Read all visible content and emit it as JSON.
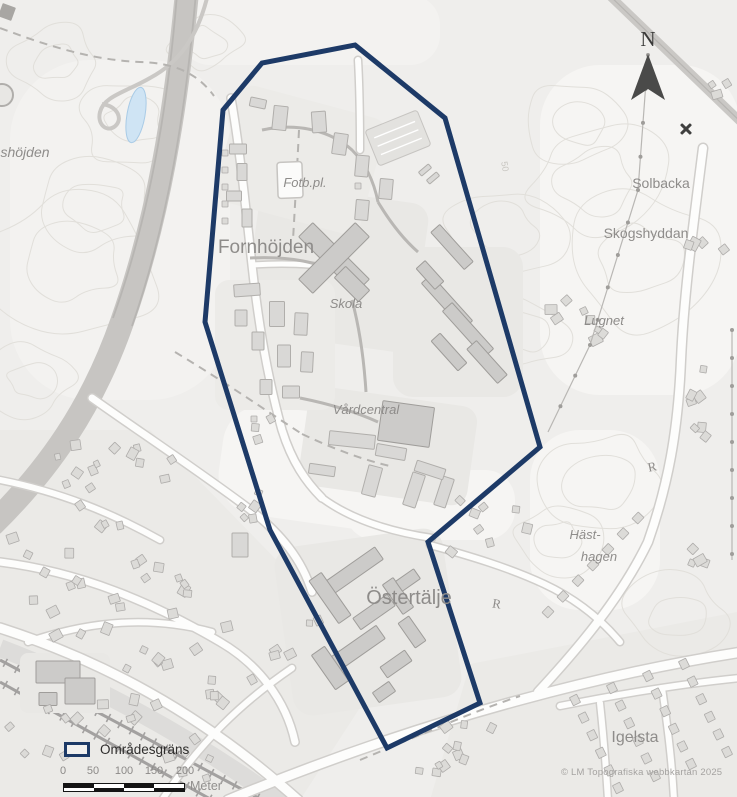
{
  "map": {
    "width": 737,
    "height": 797,
    "colors": {
      "bg": "#efeeec",
      "patch": "#f6f5f3",
      "patch2": "#f3f2f0",
      "urban": "#ebeae7",
      "contour": "#e1dfda",
      "platform": "#e9e8e5",
      "platform2": "#ecebe8",
      "road_fill": "#fdfdfc",
      "road_casing": "#d0cecb",
      "path_gray": "#b9b7b4",
      "dashed": "#b5b3b0",
      "railway": "#a3a1a0",
      "railband": "#dddcda",
      "highway": "#c7c5c2",
      "highway_lane": "#b7b5b2",
      "grayroad": "#cac8c5",
      "building_fill": "#d9d8d6",
      "building_stroke": "#b0aeab",
      "building_dark_fill": "#cccbc9",
      "building_dark_stroke": "#9f9d9a",
      "house_fill": "#dcdbd8",
      "house_stroke": "#aeacaa",
      "water": "#cfe4f4",
      "water_stroke": "#a9cbe6",
      "boundary": "#1d3a67",
      "label": "#8e8c8a",
      "label_faint": "#c8c6c1",
      "symbol_dark": "#3f3f3e",
      "field_fill": "#fbfbfa",
      "field_stroke": "#c6c4c1",
      "parking": "#e3e2df"
    },
    "boundary": {
      "points": [
        [
          355,
          45
        ],
        [
          445,
          118
        ],
        [
          540,
          447
        ],
        [
          428,
          542
        ],
        [
          480,
          703
        ],
        [
          387,
          748
        ],
        [
          270,
          530
        ],
        [
          205,
          322
        ],
        [
          223,
          110
        ],
        [
          262,
          63
        ]
      ],
      "stroke_width": 5
    },
    "labels": [
      {
        "text": "shöjden",
        "x": 25,
        "y": 157,
        "size": 14,
        "italic": true
      },
      {
        "text": "Fornhöjden",
        "x": 266,
        "y": 253,
        "size": 19
      },
      {
        "text": "Fotb.pl.",
        "x": 305,
        "y": 187,
        "size": 13,
        "italic": true
      },
      {
        "text": "Skola",
        "x": 346,
        "y": 308,
        "size": 13,
        "italic": true
      },
      {
        "text": "Vårdcentral",
        "x": 366,
        "y": 414,
        "size": 13,
        "italic": true
      },
      {
        "text": "Östertälje",
        "x": 409,
        "y": 604,
        "size": 20
      },
      {
        "text": "Solbacka",
        "x": 661,
        "y": 188,
        "size": 14
      },
      {
        "text": "Skogshyddan",
        "x": 646,
        "y": 238,
        "size": 14
      },
      {
        "text": "Lugnet",
        "x": 604,
        "y": 325,
        "size": 13,
        "italic": true
      },
      {
        "text": "Häst-",
        "x": 585,
        "y": 539,
        "size": 13,
        "italic": true
      },
      {
        "text": "hagen",
        "x": 599,
        "y": 561,
        "size": 13,
        "italic": true
      },
      {
        "text": "Igelsta",
        "x": 635,
        "y": 742,
        "size": 16
      },
      {
        "text": "R",
        "x": 653,
        "y": 471,
        "size": 13,
        "serif": true,
        "rotate": -12
      },
      {
        "text": "R",
        "x": 496,
        "y": 608,
        "size": 13,
        "serif": true,
        "rotate": 10
      },
      {
        "text": "50",
        "x": 502,
        "y": 167,
        "size": 9,
        "rotate": 80,
        "faint": true
      }
    ],
    "legend": {
      "label": "Områdesgräns"
    },
    "scalebar": {
      "ticks": [
        "0",
        "50",
        "100",
        "150",
        "200"
      ],
      "tick_x": [
        63,
        93,
        124,
        154,
        185
      ],
      "unit": "Meter"
    },
    "north": {
      "label": "N"
    },
    "copyright": "© LM Topografiska webbkartan 2025",
    "patches": [
      [
        640,
        230,
        200,
        330,
        60,
        0,
        "patch"
      ],
      [
        595,
        520,
        130,
        180,
        50,
        0,
        "patch"
      ],
      [
        120,
        230,
        220,
        340,
        80,
        0,
        "patch2"
      ],
      [
        310,
        30,
        260,
        70,
        30,
        0,
        "patch2"
      ],
      [
        330,
        470,
        220,
        110,
        40,
        8,
        "patch"
      ],
      [
        430,
        505,
        170,
        70,
        30,
        0,
        "patch"
      ]
    ],
    "urban": [
      {
        "points": "0,430 150,430 330,615 365,700 300,800 0,800"
      },
      {
        "points": "430,800 470,664 737,612 737,800"
      }
    ],
    "contours": [
      [
        95,
        205,
        62,
        3
      ],
      [
        72,
        262,
        95,
        7
      ],
      [
        132,
        122,
        55,
        13
      ],
      [
        58,
        62,
        46,
        19
      ],
      [
        598,
        182,
        75,
        23
      ],
      [
        642,
        262,
        85,
        29
      ],
      [
        578,
        122,
        55,
        31
      ],
      [
        600,
        482,
        66,
        37
      ],
      [
        558,
        540,
        46,
        41
      ],
      [
        676,
        618,
        55,
        43
      ],
      [
        505,
        232,
        64,
        47
      ],
      [
        522,
        332,
        48,
        53
      ],
      [
        30,
        380,
        46,
        59
      ],
      [
        205,
        42,
        38,
        61
      ]
    ],
    "railway": {
      "band": "M0,648 C90,682 190,736 285,805",
      "tracks": [
        [
          0,
          660,
          262,
          800
        ],
        [
          0,
          682,
          212,
          800
        ]
      ]
    },
    "highway": {
      "band": "M187,-8 C176,110 158,220 122,322 C92,408 48,470 -8,525",
      "lanes": [
        "M196,-8 C186,110 168,222 132,326",
        "M177,-6 C168,108 149,218 113,318"
      ]
    },
    "loop_road": "M208,-6 C198,36 180,62 150,78 C126,92 104,96 100,112 C97,124 106,132 114,127 C124,120 118,106 102,104",
    "topright_road": "M608,-6 L745,126",
    "platforms": [
      [
        336,
        268,
        170,
        150,
        18,
        8,
        "platform"
      ],
      [
        458,
        322,
        130,
        150,
        20,
        0,
        "platform"
      ],
      [
        388,
        446,
        170,
        100,
        16,
        8,
        "platform"
      ],
      [
        368,
        622,
        170,
        170,
        20,
        -8,
        "platform"
      ],
      [
        300,
        160,
        150,
        120,
        14,
        15,
        "platform2"
      ],
      [
        275,
        345,
        120,
        130,
        14,
        0,
        "platform2"
      ],
      [
        65,
        683,
        90,
        60,
        8,
        0,
        "platform"
      ]
    ],
    "roads": [
      [
        "M228,800 C320,762 420,727 520,700 C612,675 690,660 742,652",
        9
      ],
      [
        "M703,148 C692,235 684,295 681,360 C678,432 668,485 648,542 C620,600 575,652 538,692",
        8
      ],
      [
        "M600,703 C604,740 606,768 608,800",
        6
      ],
      [
        "M662,688 C668,730 672,762 674,800",
        6
      ],
      [
        "M92,398 C140,432 200,472 248,508 C282,534 302,560 312,592",
        7
      ],
      [
        "M0,562 C80,572 152,602 220,642 C258,664 286,700 295,742",
        7
      ],
      [
        "M162,800 C200,742 242,702 292,668",
        6
      ],
      [
        "M28,642 C92,620 152,616 212,632",
        6
      ],
      [
        "M0,480 C60,492 110,512 160,540",
        6
      ],
      [
        "M231,98 C240,150 246,210 252,265 C258,320 268,380 282,430 C292,462 306,482 322,498",
        7
      ],
      [
        "M358,60 C360,95 360,122 360,150",
        6
      ],
      [
        "M322,498 C352,520 392,532 432,538",
        6
      ],
      [
        "M430,545 C470,556 510,568 544,584 C574,598 600,618 620,642",
        6
      ],
      [
        "M0,628 C100,660 200,712 298,800",
        9
      ],
      [
        "M252,265 C298,262 328,266 352,272",
        5
      ],
      [
        "M560,706 C620,694 680,684 740,678",
        6
      ]
    ],
    "gray_paths": [
      "M262,130 C300,122 332,132 352,150 C366,164 374,182 378,202",
      "M378,202 C390,222 402,238 418,252",
      "M250,258 C290,256 320,262 344,276",
      "M300,398 C330,404 356,412 378,422",
      "M352,300 C360,330 364,360 366,392"
    ],
    "dashed_paths": [
      "M0,28 C48,46 92,60 140,62 C176,63 198,74 214,96",
      "M299,130 C297,170 295,205 293,240",
      "M175,352 C225,382 268,412 302,434",
      "M302,434 C336,450 364,460 390,466",
      "M360,760 C420,735 472,712 520,696"
    ],
    "buildings": [
      [
        280,
        118,
        14,
        24,
        6
      ],
      [
        319,
        122,
        14,
        21,
        -4
      ],
      [
        340,
        144,
        14,
        21,
        8
      ],
      [
        362,
        166,
        13,
        21,
        5
      ],
      [
        386,
        189,
        13,
        20,
        5
      ],
      [
        362,
        210,
        13,
        20,
        5
      ],
      [
        238,
        149,
        17,
        10,
        0
      ],
      [
        242,
        172,
        10,
        17,
        0
      ],
      [
        234,
        196,
        15,
        10,
        0
      ],
      [
        247,
        218,
        10,
        18,
        0
      ],
      [
        258,
        103,
        16,
        9,
        12
      ],
      [
        247,
        290,
        26,
        12,
        -4
      ],
      [
        277,
        314,
        15,
        25,
        0
      ],
      [
        301,
        324,
        13,
        22,
        3
      ],
      [
        284,
        356,
        13,
        22,
        0
      ],
      [
        307,
        362,
        12,
        20,
        3
      ],
      [
        258,
        341,
        12,
        18,
        0
      ],
      [
        241,
        318,
        12,
        16,
        0
      ],
      [
        291,
        392,
        17,
        12,
        0
      ],
      [
        266,
        387,
        12,
        15,
        0
      ],
      [
        425,
        170,
        13,
        5,
        -40
      ],
      [
        433,
        178,
        13,
        5,
        -40
      ],
      [
        352,
        440,
        46,
        14,
        6
      ],
      [
        391,
        452,
        30,
        12,
        10
      ],
      [
        322,
        470,
        26,
        10,
        8
      ],
      [
        372,
        481,
        14,
        30,
        15
      ],
      [
        414,
        490,
        13,
        34,
        18
      ],
      [
        444,
        492,
        12,
        30,
        18
      ],
      [
        430,
        470,
        30,
        11,
        18
      ],
      [
        240,
        545,
        16,
        24,
        0
      ]
    ],
    "buildings_dark": [
      [
        334,
        258,
        80,
        20,
        45
      ],
      [
        334,
        258,
        20,
        80,
        45
      ],
      [
        352,
        284,
        34,
        16,
        45
      ],
      [
        452,
        247,
        50,
        12,
        48
      ],
      [
        447,
        302,
        62,
        13,
        48
      ],
      [
        468,
        330,
        62,
        13,
        48
      ],
      [
        449,
        352,
        40,
        12,
        48
      ],
      [
        487,
        362,
        46,
        13,
        48
      ],
      [
        430,
        275,
        28,
        12,
        48
      ],
      [
        406,
        424,
        52,
        40,
        8
      ],
      [
        352,
        572,
        66,
        15,
        -35
      ],
      [
        330,
        598,
        15,
        52,
        -35
      ],
      [
        374,
        612,
        42,
        14,
        -35
      ],
      [
        398,
        596,
        13,
        36,
        -35
      ],
      [
        352,
        652,
        70,
        16,
        -35
      ],
      [
        330,
        668,
        16,
        42,
        -35
      ],
      [
        396,
        664,
        30,
        13,
        -35
      ],
      [
        412,
        632,
        13,
        30,
        -35
      ],
      [
        384,
        692,
        20,
        12,
        -35
      ],
      [
        408,
        580,
        22,
        12,
        -35
      ],
      [
        58,
        672,
        44,
        22,
        0
      ],
      [
        80,
        691,
        30,
        26,
        0
      ],
      [
        48,
        699,
        18,
        13,
        0
      ]
    ],
    "house_clusters": [
      [
        62,
        482,
        50,
        38,
        8,
        11
      ],
      [
        152,
        470,
        38,
        28,
        6,
        22
      ],
      [
        46,
        562,
        38,
        32,
        7,
        33
      ],
      [
        132,
        556,
        42,
        32,
        7,
        44
      ],
      [
        202,
        602,
        38,
        28,
        6,
        55
      ],
      [
        76,
        626,
        46,
        28,
        7,
        66
      ],
      [
        162,
        652,
        38,
        26,
        6,
        77
      ],
      [
        232,
        682,
        36,
        28,
        6,
        88
      ],
      [
        122,
        722,
        46,
        28,
        7,
        99
      ],
      [
        40,
        732,
        32,
        26,
        6,
        101
      ],
      [
        202,
        756,
        42,
        24,
        6,
        112
      ],
      [
        292,
        642,
        28,
        22,
        5,
        123
      ],
      [
        250,
        498,
        12,
        32,
        5,
        134
      ],
      [
        566,
        312,
        18,
        16,
        4,
        145
      ],
      [
        612,
        330,
        24,
        13,
        4,
        156
      ],
      [
        710,
        247,
        22,
        13,
        4,
        167
      ],
      [
        700,
        414,
        10,
        48,
        7,
        178
      ],
      [
        492,
        526,
        42,
        28,
        8,
        189
      ],
      [
        688,
        546,
        18,
        22,
        4,
        190
      ],
      [
        718,
        92,
        14,
        18,
        3,
        201
      ],
      [
        262,
        438,
        10,
        20,
        3,
        212
      ],
      [
        468,
        750,
        40,
        30,
        8,
        234
      ],
      [
        432,
        775,
        15,
        15,
        3,
        245
      ]
    ],
    "rowhouse_strips": [
      [
        548,
        612,
        638,
        518,
        7
      ],
      [
        575,
        700,
        618,
        788,
        6
      ],
      [
        612,
        688,
        655,
        776,
        6
      ],
      [
        648,
        676,
        691,
        764,
        6
      ],
      [
        684,
        664,
        727,
        752,
        6
      ]
    ],
    "houses_extra": [
      [
        225,
        153
      ],
      [
        225,
        170
      ],
      [
        225,
        187
      ],
      [
        225,
        204
      ],
      [
        225,
        221
      ],
      [
        358,
        186
      ],
      [
        254,
        419
      ]
    ],
    "field": {
      "x": 290,
      "y": 180,
      "w": 25,
      "h": 36,
      "rot": -2
    },
    "parking": {
      "x": 398,
      "y": 138,
      "w": 56,
      "h": 38,
      "rot": -22
    },
    "pond": {
      "x": 136,
      "y": 115,
      "rx": 9,
      "ry": 28,
      "rot": 10
    },
    "water_tower": {
      "x": 2,
      "y": 95,
      "r": 11
    },
    "mine_symbol": {
      "x": 686,
      "y": 129
    },
    "powerlines": [
      {
        "pts": [
          [
            648,
            55
          ],
          [
            638,
            190
          ],
          [
            590,
            345
          ],
          [
            548,
            432
          ]
        ],
        "dot_step": 34
      },
      {
        "pts": [
          [
            732,
            330
          ],
          [
            732,
            560
          ]
        ],
        "dot_step": 28
      }
    ]
  }
}
